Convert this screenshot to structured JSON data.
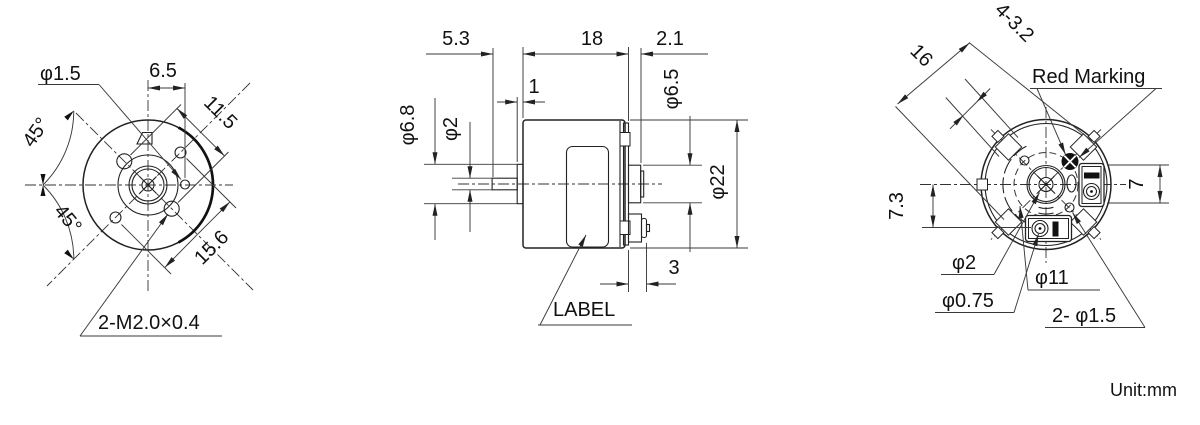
{
  "footer": {
    "unit_label": "Unit:mm"
  },
  "colors": {
    "line": "#222222",
    "background": "#ffffff",
    "marking_fill": "#111111"
  },
  "front_view": {
    "hole_dia": "φ1.5",
    "hole_offset": "6.5",
    "mount_spacing": "11.5",
    "angle_top": "45°",
    "angle_bottom": "45°",
    "pilot_spacing": "15.6",
    "thread_callout": "2-M2.0×0.4"
  },
  "side_view": {
    "shaft_length": "5.3",
    "body_length": "18",
    "rear_length": "2.1",
    "boss_length": "1",
    "boss_dia": "φ6.8",
    "shaft_dia": "φ2",
    "hub_dia": "φ6.5",
    "body_dia": "φ22",
    "terminal_length": "3",
    "label_callout": "LABEL"
  },
  "rear_view": {
    "across_pads": "16",
    "pad_callout": "4-3.2",
    "red_marking": "Red Marking",
    "terminal_height": "7",
    "terminal_offset": "7.3",
    "shaft_dia": "φ2",
    "eyelet_dia": "φ0.75",
    "bolt_circle_dia": "φ11",
    "hole_callout": "2- φ1.5"
  }
}
